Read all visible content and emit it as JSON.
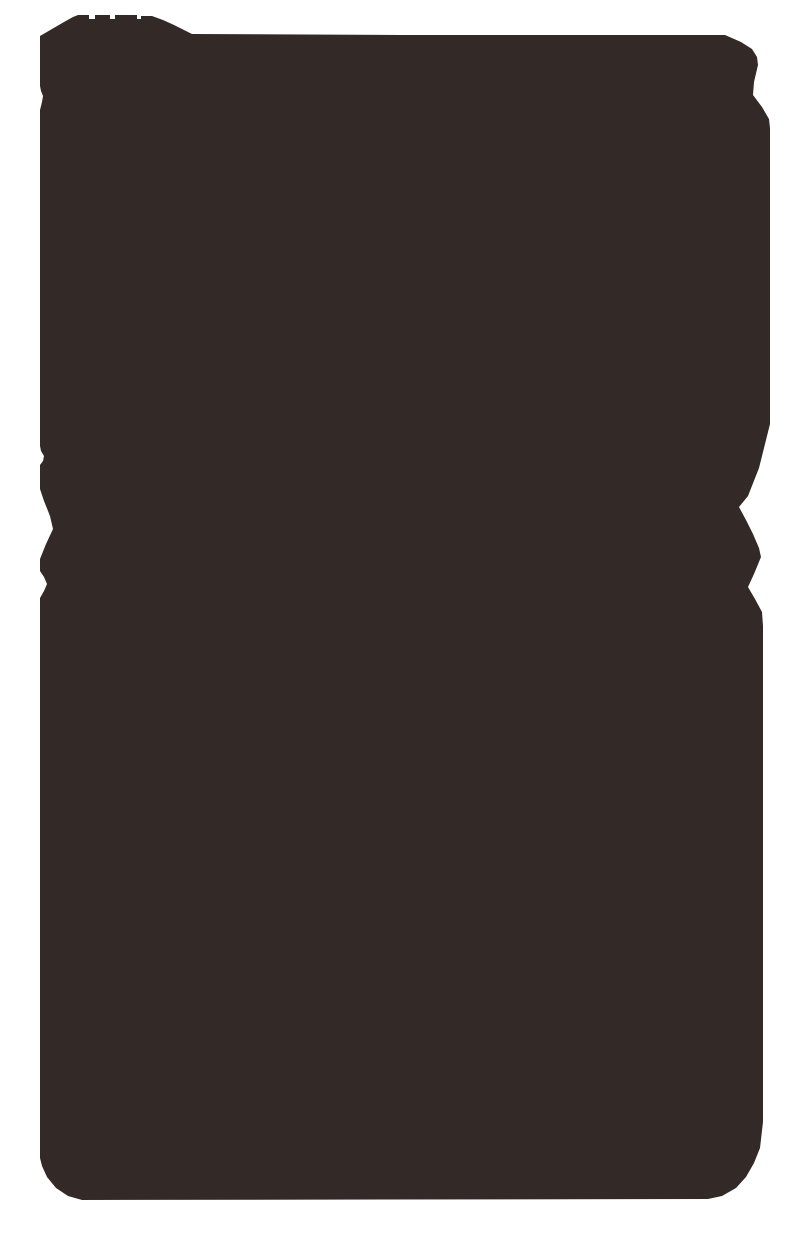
{
  "image": {
    "description": "dark-silhouette-photo",
    "background_color": "#FFFFFF",
    "silhouette_color": "#332A28",
    "viewbox": "0 0 800 1240",
    "outline_points": "40,40 40,36 52,29 64,22 73,17 78,15 89,15 89,19 95,19 95,15 110,15 110,19 115,19 115,15 137,15 137,19 141,19 141,16 152,16 163,20 174,25 186,31 192,34 400,35 725,35 741,42 752,49 757,57 758,65 754,82 753,95 762,107 769,119 770,128 770,424 768,432 759,468 748,496 739,507 746,520 753,534 759,548 761,557 754,574 748,587 755,599 762,612 763,626 763,1122 760,1148 754,1163 746,1177 736,1188 722,1196 708,1199 82,1200 68,1196 56,1188 47,1177 42,1166 40,1158 40,598 44,591 47,584 44,577 40,571 40,559 46,544 53,529 50,516 44,501 40,489 40,465 43,461 44,456 41,451 40,446 40,110 42,102 43,96 41,91 40,86"
  }
}
